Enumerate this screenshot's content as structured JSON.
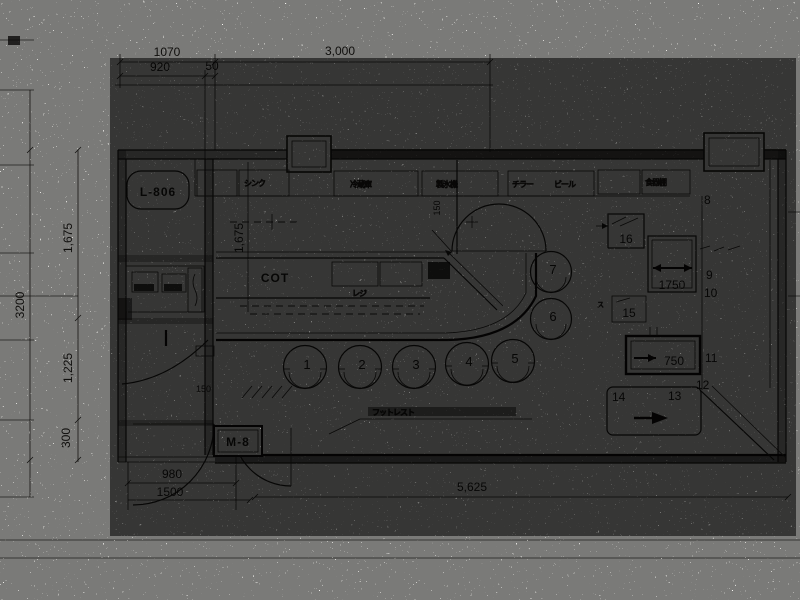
{
  "sheet": {
    "paper": "#f7f6f2",
    "ink": "#1f1d1a"
  },
  "dimensions": {
    "top": {
      "w1": "1070",
      "w2": "3,000",
      "w3": "920",
      "w4": "50"
    },
    "left": {
      "h_total": "3200",
      "h1": "1,675",
      "h2": "1,225",
      "h3": "300"
    },
    "interior": {
      "v1": "1,675",
      "v2": "150",
      "v3": "150",
      "boxA": "1750",
      "boxB": "750"
    },
    "bottom": {
      "w1": "980",
      "w2": "1500",
      "w3": "5,625"
    }
  },
  "labels": {
    "room": "L-806",
    "counter": "COT",
    "meter": "M-8",
    "katakana_su": "ス"
  },
  "seats": {
    "s1": "1",
    "s2": "2",
    "s3": "3",
    "s4": "4",
    "s5": "5",
    "s6": "6",
    "s7": "7"
  },
  "keys": {
    "k8": "8",
    "k9": "9",
    "k10": "10",
    "k11": "11",
    "k12": "12",
    "k13": "13",
    "k14": "14",
    "k15": "15",
    "k16": "16"
  },
  "equipment": {
    "back": [
      "シンク",
      "冷蔵庫",
      "製氷機",
      "チラー",
      "ビール",
      "食器棚"
    ],
    "counter": "レジ",
    "stool_note": "フットレスト"
  }
}
